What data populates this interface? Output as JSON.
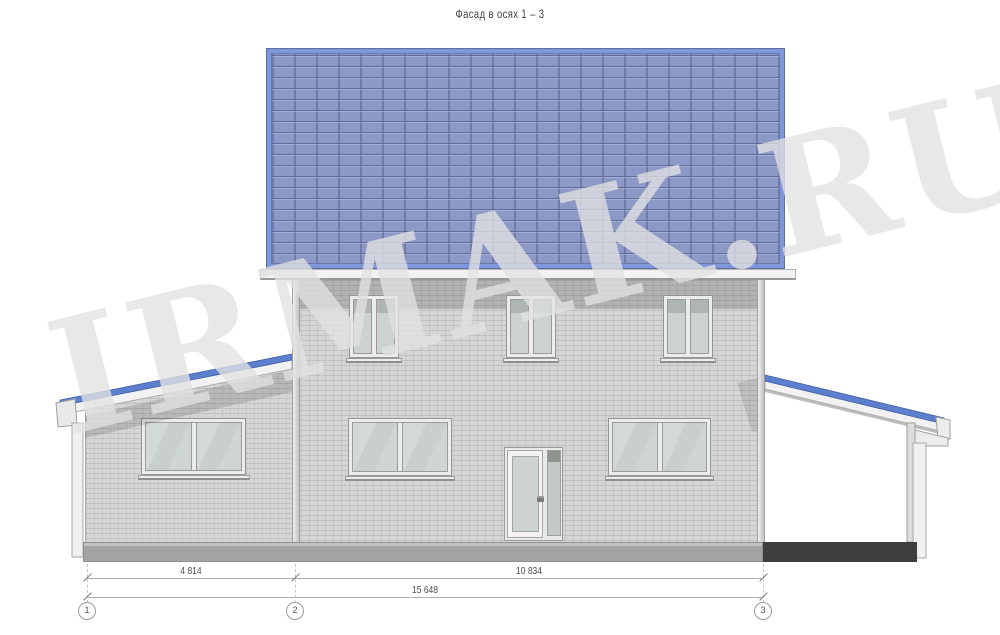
{
  "title": "Фасад в осях 1 – 3",
  "watermark": "IRMAK.RU",
  "dimensions": {
    "span_1_2": "4 814",
    "span_2_3": "10 834",
    "total": "15 648"
  },
  "axes": {
    "a1": "1",
    "a2": "2",
    "a3": "3"
  },
  "colors": {
    "roof_field_blue": "#8c98c6",
    "roof_edge_blue": "#7e96da",
    "porch_roof_blue": "#5c7fd0",
    "wall_gray": "#d5d5d5",
    "eave_shadow": "rgba(40,40,40,0.20)",
    "glass_green_gray": "#cbd2cf",
    "plinth_gray": "#a3a3a3",
    "plinth_dark": "#3e3e3e",
    "dimension_text": "#4a4a4a"
  }
}
